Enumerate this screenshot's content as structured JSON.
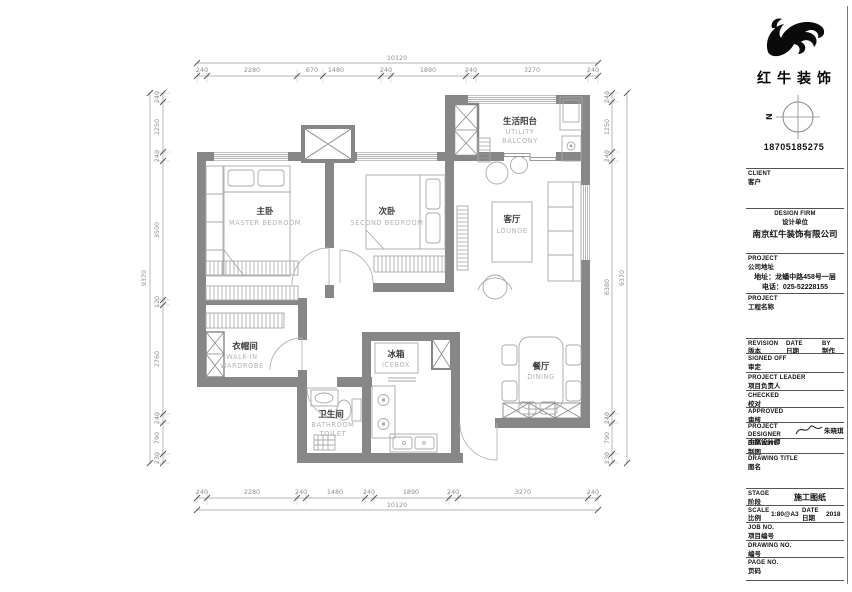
{
  "plan": {
    "rooms": {
      "master": {
        "zh": "主卧",
        "en": "MASTER  BEDROOM"
      },
      "second": {
        "zh": "次卧",
        "en": "SECOND  BEDROOM"
      },
      "lounge": {
        "zh": "客厅",
        "en": "LOUNGE"
      },
      "balcony": {
        "zh": "生活阳台",
        "en1": "UTILITY",
        "en2": "BALCONY"
      },
      "wardrobe": {
        "zh": "衣帽间",
        "en1": "WALK-IN",
        "en2": "WARDROBE"
      },
      "bathroom": {
        "zh": "卫生间",
        "en1": "BATHROOM",
        "en2": "TOILET"
      },
      "icebox": {
        "zh": "冰箱",
        "en": "ICEBOX"
      },
      "dining": {
        "zh": "餐厅",
        "en": "DINING"
      }
    },
    "dims": {
      "top": {
        "total": "10120",
        "segments": [
          "240",
          "2280",
          "670",
          "1480",
          "240",
          "1890",
          "240",
          "3270",
          "240"
        ]
      },
      "bottom": {
        "total": "10120",
        "segments": [
          "240",
          "2280",
          "240",
          "1480",
          "240",
          "1890",
          "240",
          "3270",
          "240"
        ]
      },
      "left": {
        "total": "9370",
        "segments": [
          "240",
          "1250",
          "240",
          "3500",
          "120",
          "2760",
          "240",
          "790",
          "230"
        ]
      },
      "right": {
        "total": "9370",
        "segments": [
          "240",
          "1250",
          "240",
          "6380",
          "240",
          "790",
          "230"
        ]
      }
    }
  },
  "titleblock": {
    "brand": {
      "name": "红牛装饰",
      "phone": "18705185275",
      "compass_n": "N"
    },
    "sections": {
      "client": {
        "en": "CLIENT",
        "zh": "客户"
      },
      "design_firm": {
        "en": "DESIGN FIRM",
        "zh": "设计单位",
        "value": "南京红牛装饰有限公司"
      },
      "company_address": {
        "en": "PROJECT",
        "zh": "公司地址",
        "line1": "地址：龙蟠中路458号一层",
        "line2": "电话：025-52228155"
      },
      "project_name": {
        "en": "PROJECT",
        "zh": "工程名称"
      },
      "revision": {
        "en": "REVISION",
        "zh": "版本"
      },
      "date_col": {
        "en": "DATE",
        "zh": "日期"
      },
      "by": {
        "en": "BY",
        "zh": "制作"
      },
      "signed_off": {
        "en": "SIGNED OFF",
        "zh": "审定"
      },
      "project_leader": {
        "en": "PROJECT LEADER",
        "zh": "项目负责人"
      },
      "checked": {
        "en": "CHECKED",
        "zh": "校对"
      },
      "approved": {
        "en": "APPROVED",
        "zh": "审核"
      },
      "project_designer": {
        "en": "PROJECT DESIGNER",
        "zh": "主案设计师",
        "value": "朱晓琪"
      },
      "drawing": {
        "en": "DRAWING",
        "zh": "制图"
      },
      "drawing_title": {
        "en": "DRAWING TITLE",
        "zh": "图名"
      },
      "stage": {
        "en": "STAGE",
        "zh": "阶段",
        "value": "施工图纸"
      },
      "scale": {
        "en": "SCALE",
        "zh": "比例",
        "value": "1:80@A3"
      },
      "date2": {
        "en": "DATE",
        "zh": "日期",
        "value": "2018"
      },
      "job_no": {
        "en": "JOB NO.",
        "zh": "项目编号"
      },
      "drawing_no": {
        "en": "DRAWING NO.",
        "zh": "编号"
      },
      "page_no": {
        "en": "PAGE NO.",
        "zh": "页码"
      }
    }
  },
  "colors": {
    "wall": "#878787",
    "furniture_line": "#a9a9a9",
    "dimension": "#8f8f8f",
    "ink": "#111111"
  }
}
